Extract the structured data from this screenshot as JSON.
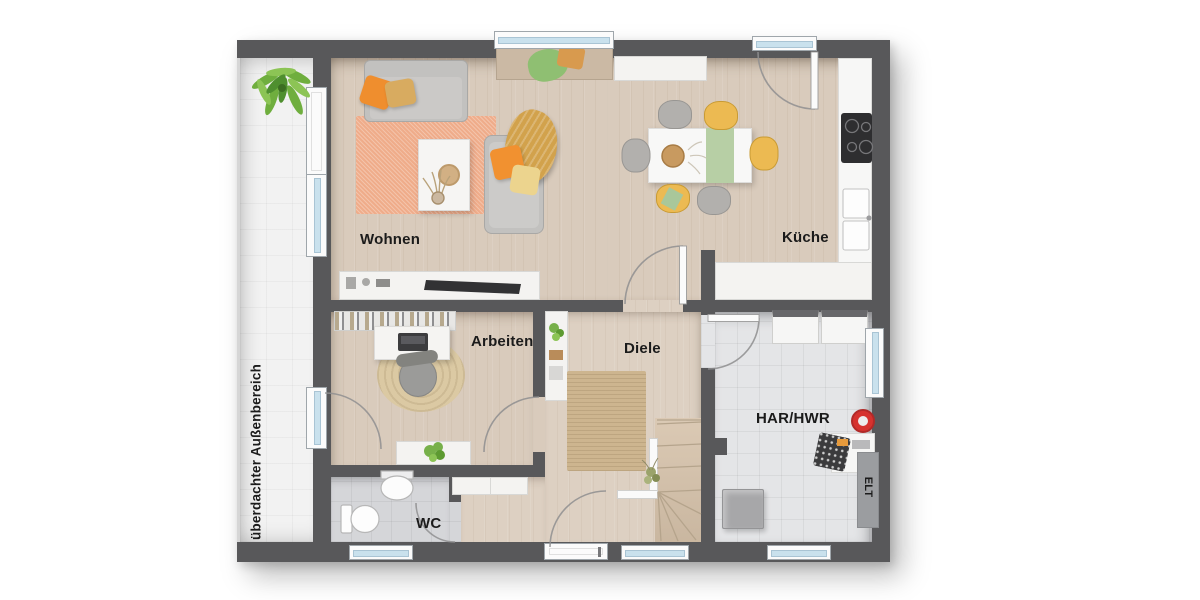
{
  "floorplan": {
    "outdoor_area_label": "überdachter Außenbereich",
    "rooms": {
      "wohnen": "Wohnen",
      "kueche": "Küche",
      "arbeiten": "Arbeiten",
      "diele": "Diele",
      "har_hwr": "HAR/HWR",
      "wc": "WC"
    },
    "elt_label": "ELT",
    "colors": {
      "wall": "#58585a",
      "wood_floor": "#d9cbbc",
      "utility_floor": "#e4e5e7",
      "wc_floor": "#d5d6d9",
      "outdoor_floor": "#f2f2f2",
      "window_glass": "#c9e1ed",
      "rug_salmon": "#efac8a",
      "rug_jute": "#cdb58f",
      "accent_orange": "#ef8e2e",
      "accent_mustard": "#d2a24c",
      "accent_yellow": "#ecba52",
      "accent_green": "#b7cfa5",
      "vacuum_red": "#d6322e"
    }
  }
}
